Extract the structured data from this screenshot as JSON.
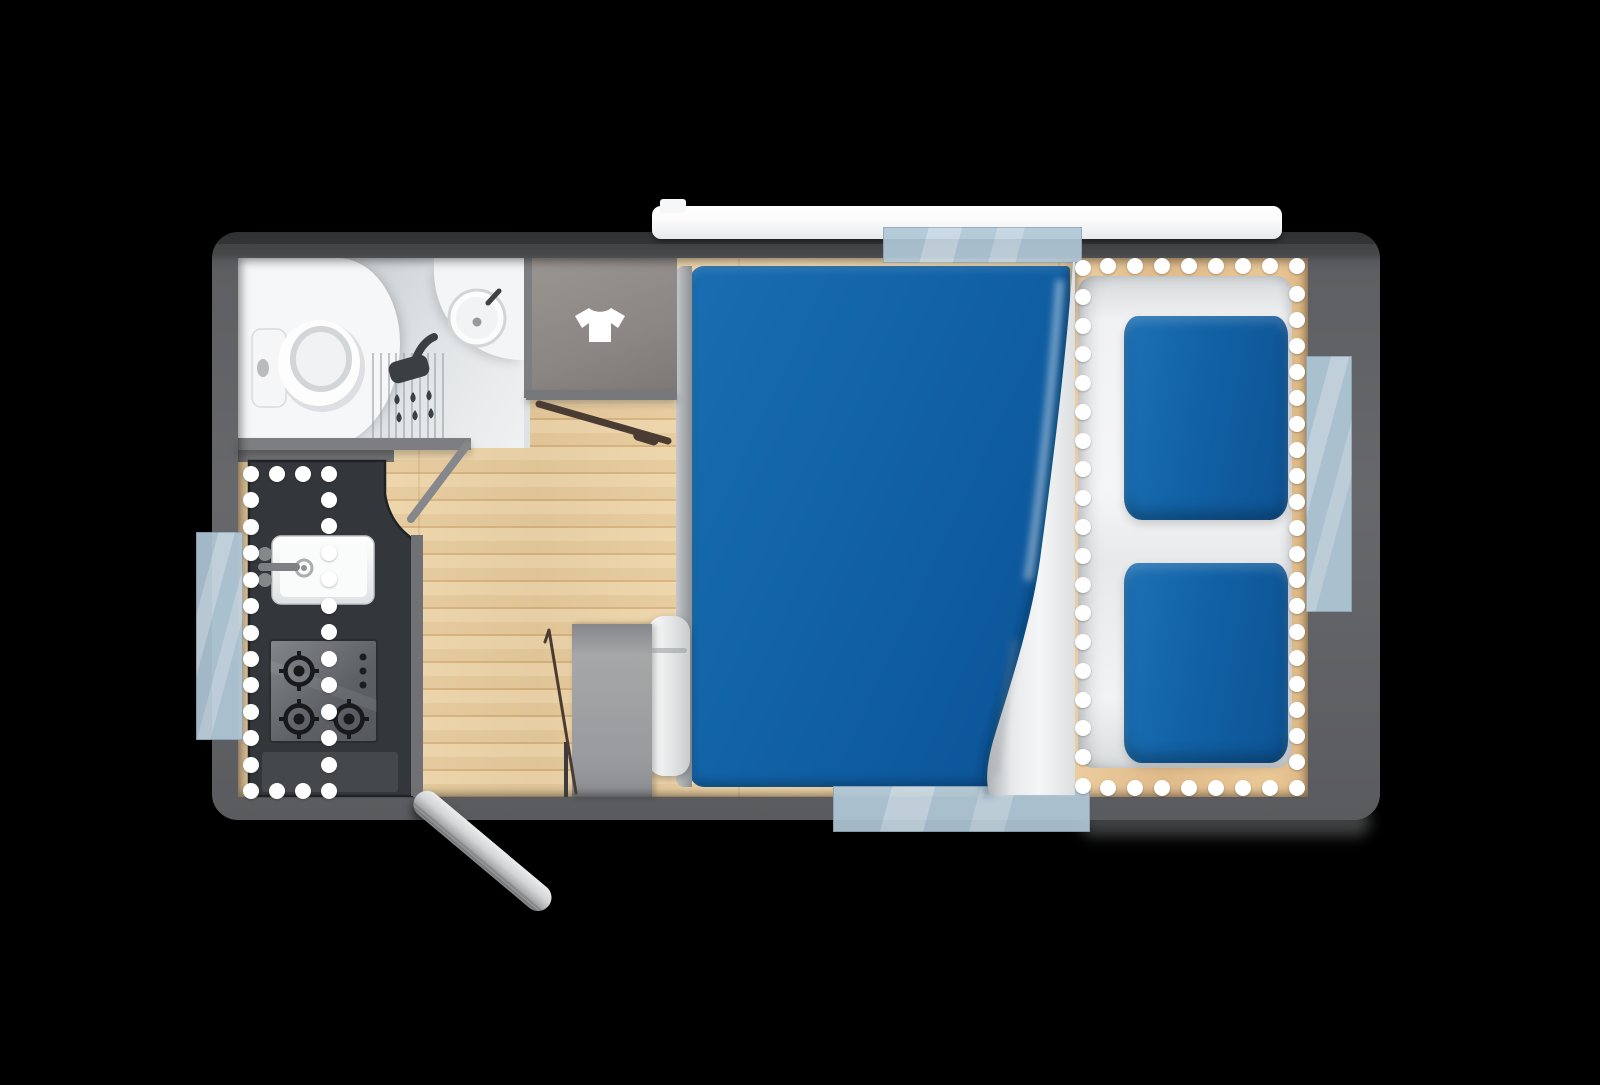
{
  "diagram": {
    "type": "caravan-floor-plan",
    "view": "top-down",
    "rooms": [
      "bathroom",
      "wardrobe",
      "kitchen",
      "bedroom-double-bed",
      "rear-lounge-seating"
    ],
    "features": [
      "toilet",
      "washbasin",
      "shower",
      "wardrobe-tshirt",
      "kitchen-sink",
      "gas-hob-3-burner",
      "double-bed",
      "curtain-divider",
      "two-lounge-cushions",
      "entry-door",
      "interior-doors",
      "four-windows",
      "roof-strip"
    ]
  },
  "colors": {
    "body": "#5e5f62",
    "body_top": "#48494c",
    "floor_light": "#f3d9ad",
    "floor_mid": "#eccf9f",
    "floor_seam": "#ddb780",
    "wood_trim": "#dbbf95",
    "counter": "#33363a",
    "counter_edge": "#202326",
    "bed_blue": "#1263a8",
    "bed_blue_dark": "#0b5195",
    "bed_blue_light": "#1a6db0",
    "cushion_blue": "#1161a5",
    "seat_white": "#f1f2f3",
    "bathroom_base": "#dfe2e4",
    "bathroom_white": "#f6f7f8",
    "shower_gray": "#c7cbce",
    "wall": "#7c7e81",
    "wardrobe": "#8b8683",
    "window_glass": "#b0c8d8",
    "dot": "#ffffff",
    "dark_icon": "#3b3e42",
    "door_brown": "#4a3c33",
    "entry_door": "#d2d4d6"
  },
  "led_dots": {
    "size": 16,
    "segments": [
      {
        "name": "kitchen-left",
        "x1": 251,
        "y1": 474,
        "x2": 251,
        "y2": 791,
        "n": 13
      },
      {
        "name": "kitchen-top",
        "x1": 277,
        "y1": 474,
        "x2": 329,
        "y2": 474,
        "n": 3
      },
      {
        "name": "kitchen-mid",
        "x1": 329,
        "y1": 500,
        "x2": 329,
        "y2": 791,
        "n": 12
      },
      {
        "name": "kitchen-bottom",
        "x1": 277,
        "y1": 791,
        "x2": 303,
        "y2": 791,
        "n": 2
      },
      {
        "name": "curtain-track",
        "x1": 1083,
        "y1": 268,
        "x2": 1083,
        "y2": 786,
        "n": 19
      },
      {
        "name": "lounge-top",
        "x1": 1108,
        "y1": 266,
        "x2": 1297,
        "y2": 266,
        "n": 8
      },
      {
        "name": "lounge-right",
        "x1": 1297,
        "y1": 294,
        "x2": 1297,
        "y2": 788,
        "n": 20
      },
      {
        "name": "lounge-bottom",
        "x1": 1108,
        "y1": 788,
        "x2": 1270,
        "y2": 788,
        "n": 7
      }
    ]
  },
  "shower_stripes": {
    "x_start": 372,
    "x_end": 450,
    "step": 7.8,
    "y": 353,
    "height": 85
  },
  "hob": {
    "burners": [
      {
        "cx": 299,
        "cy": 671
      },
      {
        "cx": 299,
        "cy": 719
      },
      {
        "cx": 349,
        "cy": 719
      }
    ],
    "controls": [
      {
        "cx": 363,
        "cy": 657
      },
      {
        "cx": 363,
        "cy": 671
      },
      {
        "cx": 363,
        "cy": 685
      }
    ]
  },
  "windows": [
    {
      "name": "window-top"
    },
    {
      "name": "window-right"
    },
    {
      "name": "window-bottom"
    },
    {
      "name": "window-left"
    }
  ]
}
